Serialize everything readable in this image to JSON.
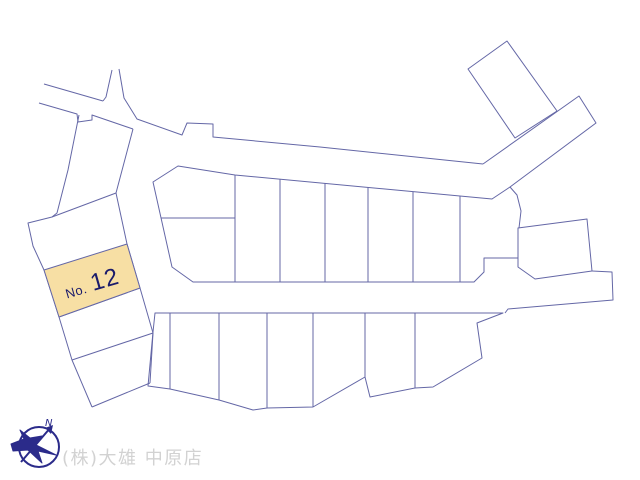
{
  "map": {
    "background": "#ffffff",
    "line_color": "#6467a6",
    "highlight": {
      "label_prefix": "No.",
      "label_number": "12",
      "fill": "#f7dfa4",
      "text_color": "#1b1b6b"
    },
    "compass": {
      "north_label": "N",
      "color": "#2b2b8a"
    },
    "credit": "(株)大雄 中原店",
    "credit_color": "#d2d2d2",
    "shapes": [
      {
        "name": "central-block-parcel-outline",
        "kind": "polygon",
        "points": "153,182 178,166 235,175 492,199 510,187 517,195 521,211 519,228 518,258 484,258 484,272 474,282 193,282 172,267",
        "fill": "#ffffff"
      },
      {
        "name": "lower-block-parcel-outline",
        "kind": "polygon",
        "points": "155,313 503,313 477,323 482,358 433,387 415,388 370,397 365,377 313,407 267,408 253,410 219,400 170,389 148,386 153,332",
        "fill": "#ffffff"
      },
      {
        "name": "upper-right-parcel",
        "kind": "polygon",
        "points": "507,41 468,69 515,138 557,111",
        "fill": "#ffffff"
      },
      {
        "name": "east-parcel",
        "kind": "polygon",
        "points": "518,228 587,219 592,271 535,279 518,267",
        "fill": "#ffffff"
      },
      {
        "name": "road-upper-left-top-edge",
        "kind": "polyline",
        "points": "44,84 103,101"
      },
      {
        "name": "road-north-stub-left-edge",
        "kind": "polyline",
        "points": "112,70 106,97 103,101"
      },
      {
        "name": "road-main-north-edge",
        "kind": "polyline",
        "points": "119,69 124,98 137,119 182,135 187,123 213,124 213,137 320,147 483,164"
      },
      {
        "name": "road-upper-left-bottom-edge",
        "kind": "polyline",
        "points": "39,103 77,114 78,122 92,120 92,115 133,129"
      },
      {
        "name": "west-strip-west-edge",
        "kind": "polyline",
        "points": "79,115 68,170 57,213 52,217 28,223 33,246 44,270 59,317 72,360 92,407"
      },
      {
        "name": "west-strip-east-edge",
        "kind": "polyline",
        "points": "133,129 116,193 127,244 140,288 153,333 150,383"
      },
      {
        "name": "west-strip-bottom-edge",
        "kind": "polyline",
        "points": "92,407 150,383"
      },
      {
        "name": "west-strip-divider-1",
        "kind": "polyline",
        "points": "52,217 116,193"
      },
      {
        "name": "west-strip-divider-2",
        "kind": "polyline",
        "points": "59,317 140,288"
      },
      {
        "name": "west-strip-divider-3",
        "kind": "polyline",
        "points": "72,360 153,333"
      },
      {
        "name": "central-block-horizontal-divider",
        "kind": "polyline",
        "points": "161,218 235,218"
      },
      {
        "name": "central-block-divider-1",
        "kind": "polyline",
        "points": "235,175 235,282"
      },
      {
        "name": "central-block-divider-2",
        "kind": "polyline",
        "points": "280,179 280,282"
      },
      {
        "name": "central-block-divider-3",
        "kind": "polyline",
        "points": "325,183 325,282"
      },
      {
        "name": "central-block-divider-4",
        "kind": "polyline",
        "points": "368,187 368,282"
      },
      {
        "name": "central-block-divider-5",
        "kind": "polyline",
        "points": "413,192 413,282"
      },
      {
        "name": "central-block-divider-6",
        "kind": "polyline",
        "points": "460,196 460,282"
      },
      {
        "name": "road-northeast-edges",
        "kind": "polyline",
        "points": "483,164 579,96 596,123 510,187"
      },
      {
        "name": "road-east-boundary",
        "kind": "polyline",
        "points": "592,271 612,272 613,300 508,309 505,313"
      },
      {
        "name": "lower-block-divider-1",
        "kind": "polyline",
        "points": "170,313 170,389"
      },
      {
        "name": "lower-block-divider-2",
        "kind": "polyline",
        "points": "219,313 219,400"
      },
      {
        "name": "lower-block-divider-3",
        "kind": "polyline",
        "points": "267,313 267,408"
      },
      {
        "name": "lower-block-divider-4",
        "kind": "polyline",
        "points": "313,313 313,407"
      },
      {
        "name": "lower-block-divider-5",
        "kind": "polyline",
        "points": "365,313 365,377"
      },
      {
        "name": "lower-block-divider-6",
        "kind": "polyline",
        "points": "415,313 415,388"
      },
      {
        "name": "parcel-no12-highlight",
        "kind": "polygon",
        "points": "44,270 127,244 140,288 59,317",
        "fill": "#f7dfa4"
      },
      {
        "name": "compass-circle",
        "kind": "circle",
        "cx": 39,
        "cy": 447,
        "r": 20,
        "stroke": "#2b2b8a",
        "width": 2
      },
      {
        "name": "compass-needle",
        "kind": "polyline",
        "points": "21,462 51,427",
        "stroke": "#2b2b8a",
        "width": 2
      },
      {
        "name": "compass-arrowhead",
        "kind": "polygon",
        "points": "53,425 51,434 45,428",
        "fill": "#2b2b8a",
        "stroke": "none"
      },
      {
        "name": "compass-bird",
        "kind": "polygon",
        "points": "11,444 24,439 20,430 30,438 42,436 36,445 56,455 38,451 42,463 28,450 13,451",
        "fill": "#2b2b8a",
        "stroke": "#2b2b8a"
      }
    ]
  }
}
